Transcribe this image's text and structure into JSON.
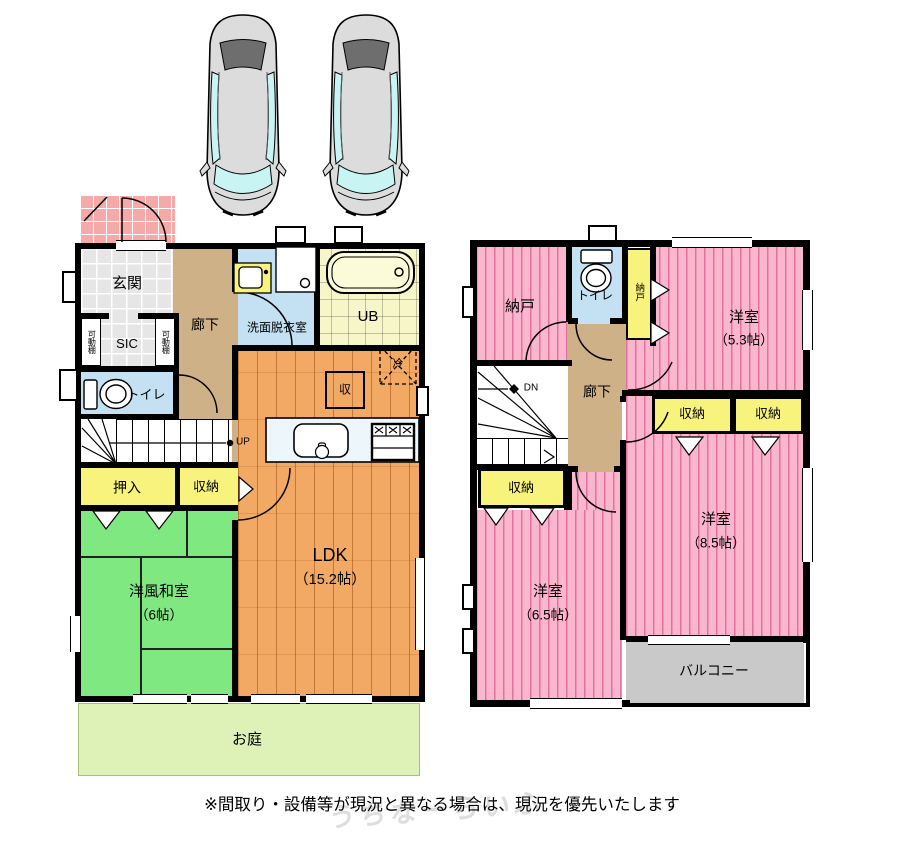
{
  "floor1": {
    "entrance": "玄関",
    "sic": "SIC",
    "movable_shelf": "可動棚",
    "hallway": "廊下",
    "toilet": "トイレ",
    "washroom": "洗面脱衣室",
    "unit_bath": "UB",
    "up": "UP",
    "closet_oshiire": "押入",
    "closet": "収納",
    "storage_mark": "収",
    "fridge_mark": "冷",
    "japanese_room": "洋風和室",
    "japanese_room_size": "（6帖）",
    "ldk": "LDK",
    "ldk_size": "（15.2帖）",
    "garden": "お庭"
  },
  "floor2": {
    "storage_room": "納戸",
    "toilet": "トイレ",
    "closet_nando": "納戸",
    "hallway": "廊下",
    "down": "DN",
    "closet": "収納",
    "western_room": "洋室",
    "room53_size": "（5.3帖）",
    "room65_size": "（6.5帖）",
    "room85_size": "（8.5帖）",
    "balcony": "バルコニー"
  },
  "footer": {
    "disclaimer": "※間取り・設備等が現況と異なる場合は、現況を優先いたします",
    "watermark": "うちなーらいふ"
  },
  "colors": {
    "wall": "#000000",
    "room_pink": "#f9b6cc",
    "stripe_pink": "#e2719f",
    "wood_orange": "#f2a964",
    "tatami_green": "#80e880",
    "closet_yellow": "#f7f37d",
    "corridor_tan": "#cfb187",
    "water_blue": "#c3e1f2",
    "bath_yellow": "#f6f6c8",
    "porch_pink": "#f5a9a9",
    "balcony_gray": "#c9c9c9",
    "garden_green": "#def2b8",
    "car_body": "#dcdcdc",
    "car_glass": "#c9f4f4"
  }
}
